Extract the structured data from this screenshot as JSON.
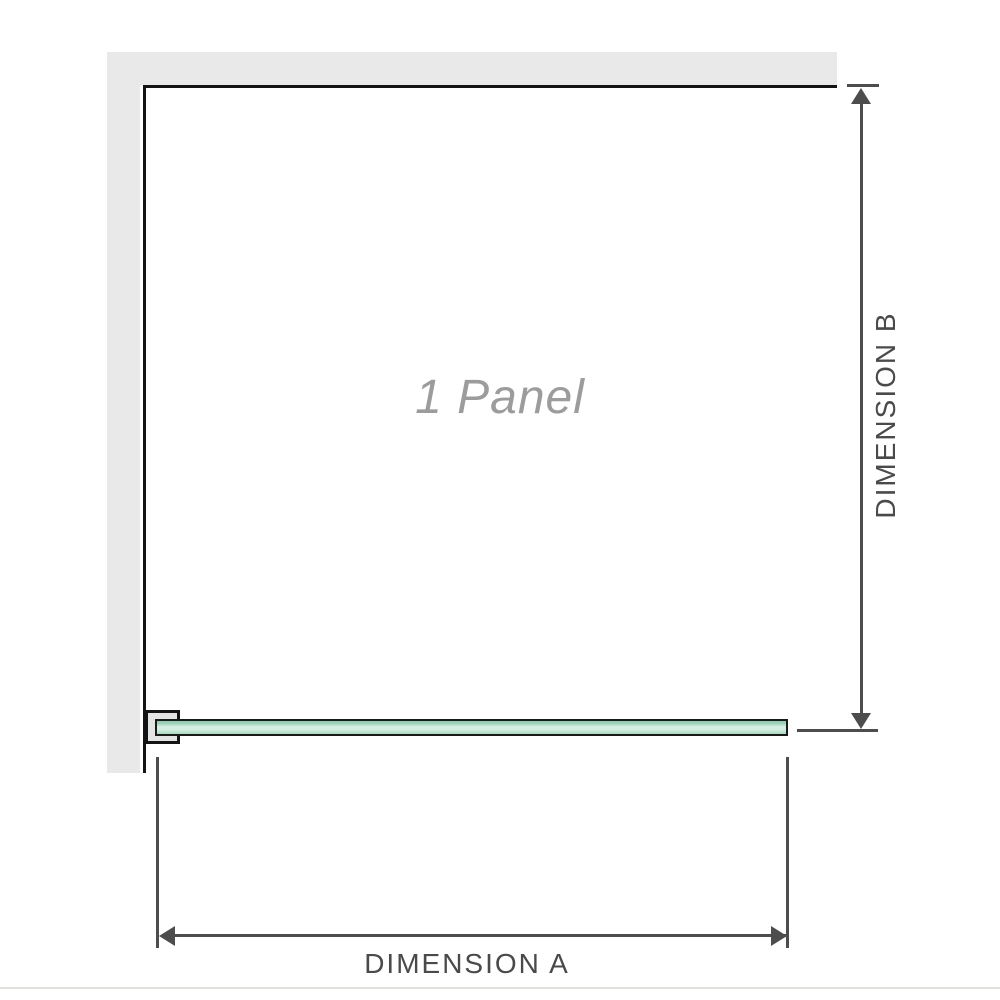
{
  "diagram": {
    "panel_label": "1 Panel",
    "dimension_a_label": "DIMENSION A",
    "dimension_b_label": "DIMENSION B"
  },
  "colors": {
    "wall_fill": "#e9e9e9",
    "enclosure_outline": "#141414",
    "bracket_fill": "#e4e4e4",
    "glass_fill": "#cfeadd",
    "glass_highlight": "#d9efe3",
    "glass_shadow": "#8fcbae",
    "glass_edge": "#1a1a1a",
    "dimension_line": "#4d4d4d",
    "dimension_text": "#4a4a4a",
    "panel_label_text": "#9c9c9c",
    "baseline": "#e3e1de",
    "background": "#ffffff"
  }
}
